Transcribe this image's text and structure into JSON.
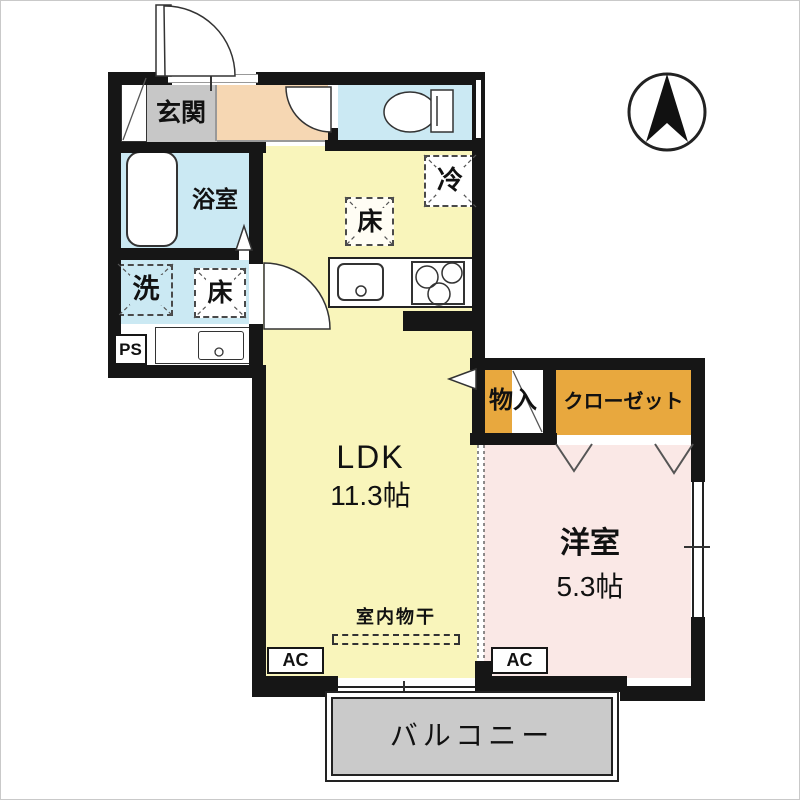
{
  "labels": {
    "genkan": "玄関",
    "bathroom": "浴室",
    "laundry": "洗",
    "floor_wash": "床",
    "floor_kitchen": "床",
    "fridge": "冷",
    "ps": "PS",
    "ldk_name": "LDK",
    "ldk_size": "11.3帖",
    "storage": "物入",
    "closet": "クローゼット",
    "western_name": "洋室",
    "western_size": "5.3帖",
    "indoor_drying": "室内物干",
    "ac_ldk": "AC",
    "ac_western": "AC",
    "balcony": "バルコニー"
  },
  "icons": {
    "compass": "north-arrow"
  },
  "colors": {
    "wall": "#161616",
    "ldk_fill": "#F9F5BB",
    "wet_area_fill": "#CBE9F3",
    "hall_fill": "#F6D7B3",
    "genkan_fill": "#C7C7C7",
    "western_fill": "#FAE8E6",
    "closet_fill": "#E8A83E",
    "balcony_fill": "#CACACA"
  }
}
